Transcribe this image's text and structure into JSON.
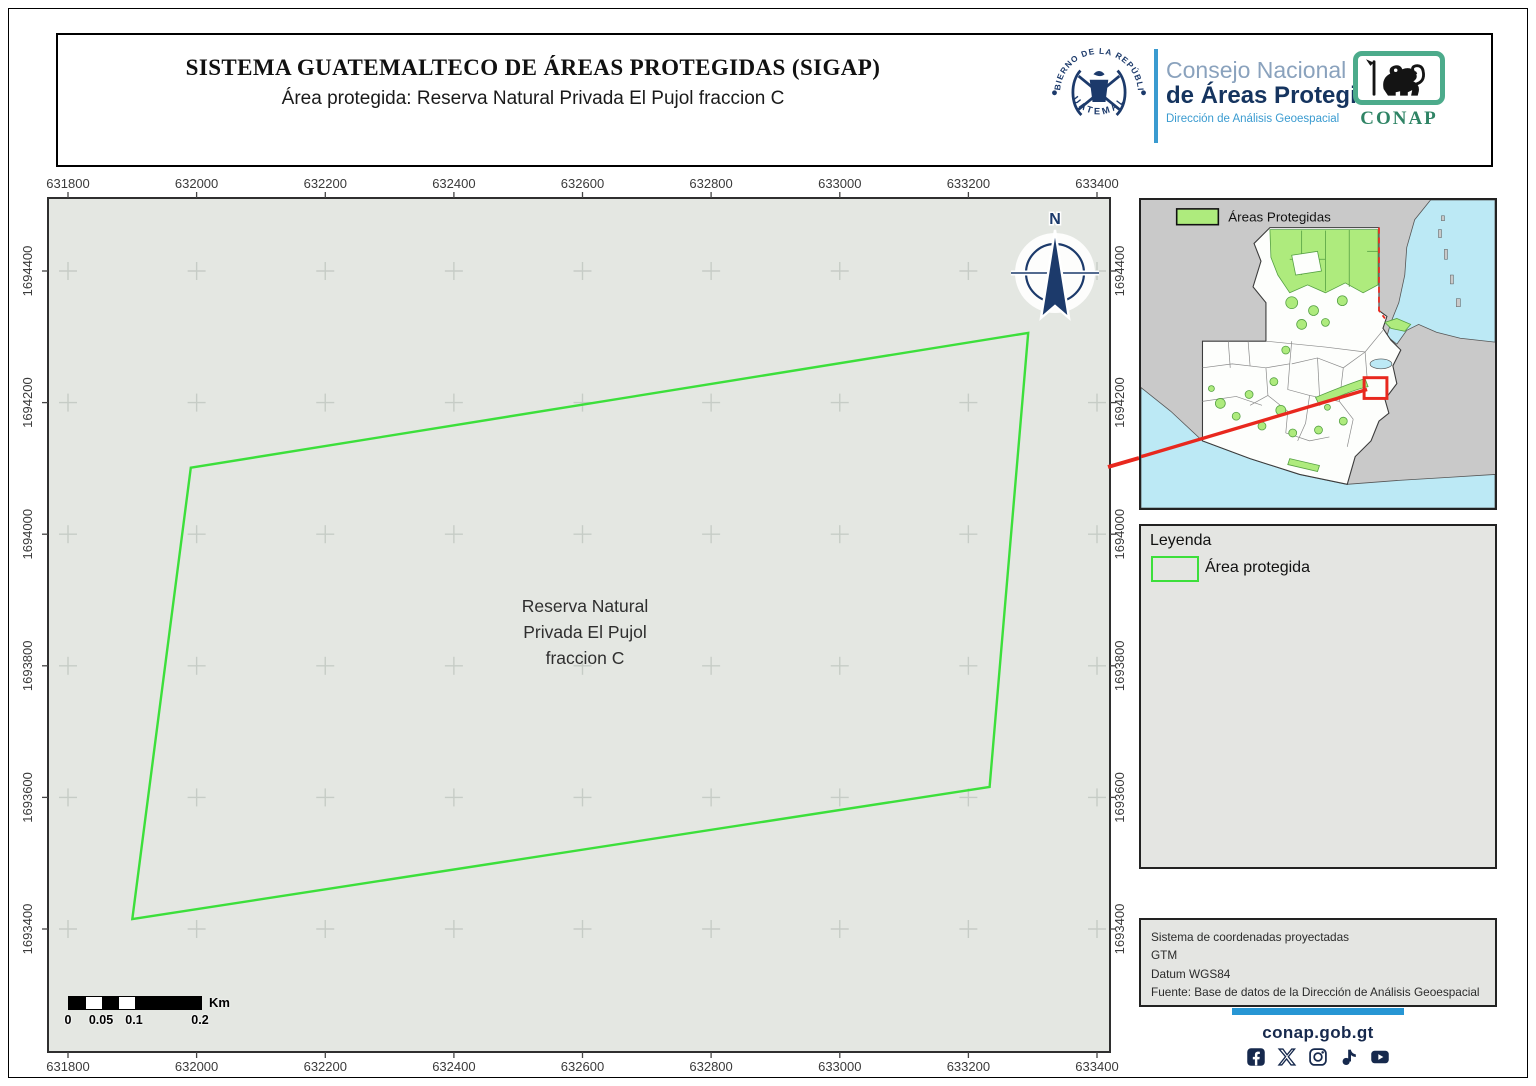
{
  "header": {
    "title": "SISTEMA GUATEMALTECO DE ÁREAS PROTEGIDAS  (SIGAP)",
    "subtitle": "Área protegida: Reserva Natural Privada El Pujol fraccion C",
    "gov_seal": {
      "top_text": "GOBIERNO DE LA REPÚBLICA",
      "bottom_text": "GUATEMALA"
    },
    "org": {
      "line1": "Consejo Nacional",
      "line2": "de Áreas Protegidas",
      "line3": "Dirección de Análisis Geoespacial"
    },
    "conap_wordmark": "CONAP"
  },
  "map": {
    "north_label": "N",
    "area_label": [
      "Reserva Natural",
      "Privada El Pujol",
      "fraccion C"
    ],
    "x_ticks": [
      631800,
      632000,
      632200,
      632400,
      632600,
      632800,
      633000,
      633200,
      633400
    ],
    "y_ticks": [
      1694400,
      1694200,
      1694000,
      1693800,
      1693600,
      1693400
    ],
    "polygon_map_coords": [
      [
        631991,
        1694101
      ],
      [
        633293,
        1694306
      ],
      [
        633233,
        1693616
      ],
      [
        631900,
        1693415
      ]
    ],
    "scalebar": {
      "labels": [
        "0",
        "0.05",
        "0.1",
        "0.2"
      ],
      "unit": "Km"
    }
  },
  "inset": {
    "legend_label": "Áreas Protegidas"
  },
  "legend": {
    "title": "Leyenda",
    "item_label": "Área protegida"
  },
  "info_box": {
    "lines": [
      "Sistema de coordenadas proyectadas",
      "GTM",
      "Datum WGS84",
      "Fuente: Base de datos de la Dirección de Análisis Geoespacial"
    ]
  },
  "footer": {
    "website": "conap.gob.gt",
    "icons": [
      "facebook-icon",
      "x-icon",
      "instagram-icon",
      "tiktok-icon",
      "youtube-icon"
    ]
  },
  "colors": {
    "red": "#e8281e",
    "polygon_green": "#3cdf3b",
    "pa_green": "#aeeb7d",
    "pa_green_dark": "#55a043",
    "water": "#bce9f5",
    "land_gray": "#c9c9c9",
    "country_white": "#fdfefc",
    "map_bg": "#e4e7e2",
    "box_bg": "#e4e5e2",
    "navy": "#1c3a6b",
    "footer_navy": "#16294d",
    "link_blue": "#2796d4",
    "org_blue_light": "#8aa2bd",
    "org_blue_dark": "#15345f",
    "org_blue_accent": "#3a9bd0",
    "conap_border": "#4cab8b",
    "conap_green": "#2f8465",
    "frame_dark": "#2f2f2f",
    "grid_cross": "#c6ccc6"
  }
}
